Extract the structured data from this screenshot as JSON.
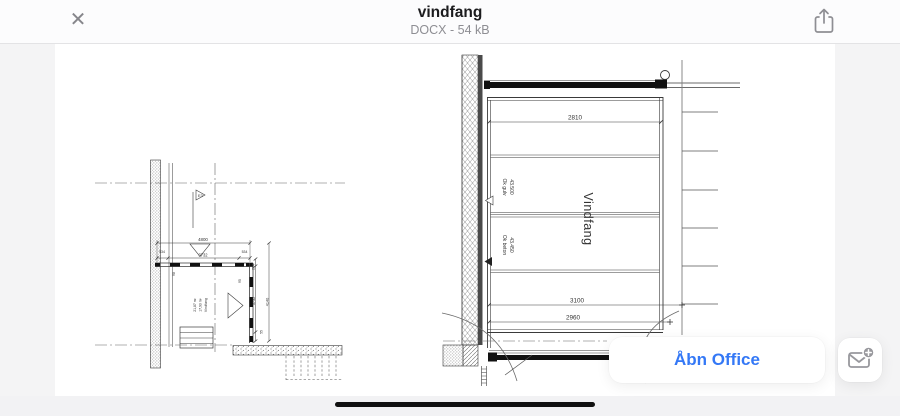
{
  "header": {
    "title": "vindfang",
    "subtitle": "DOCX - 54 kB"
  },
  "actions": {
    "open_office_label": "Åbn Office"
  },
  "icons": {
    "close": "close-icon",
    "share": "share-icon",
    "mail_plus": "mail-plus-icon"
  },
  "colors": {
    "accent_blue": "#3478f6",
    "icon_gray": "#8e8e93",
    "line": "#3a3a3a"
  },
  "drawing": {
    "left_plan": {
      "section_marker": "E3",
      "dim_total": "4800",
      "dim_offset_left": "534",
      "dim_inner": "3732",
      "dim_offset_right": "534",
      "dim_wall_left": "98",
      "dim_wall_right": "95",
      "dim_right_top": "204",
      "dim_right_inner": "3732",
      "dim_right_total": "4140",
      "dim_bottom_small": "55",
      "room_area_2": "21,87 m²",
      "room_area_1": "17,93 m²",
      "room_name": "Vindfang"
    },
    "right_plan": {
      "dim_top": "2810",
      "floor_level_label": "Ok gulv",
      "floor_level_value": "43.500",
      "concrete_level_label": "Ok beton",
      "concrete_level_value": "43.450",
      "room_name": "Vindfang",
      "dim_bottom_total": "3100",
      "dim_bottom_inner": "2960"
    }
  }
}
